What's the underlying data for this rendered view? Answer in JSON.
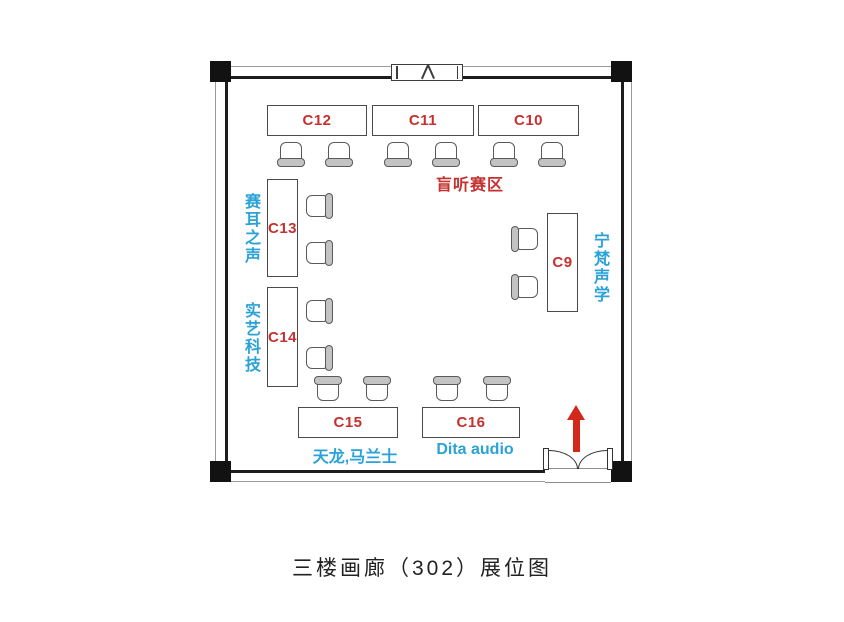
{
  "title": "三楼画廊（302）展位图",
  "colors": {
    "booth_label_red": "#c4312e",
    "brand_label_cyan": "#2aa2d8",
    "entrance_arrow_red": "#d2281c",
    "wall_black": "#1d1d1d"
  },
  "zones": {
    "blind_listening": "盲听赛区"
  },
  "booths": {
    "c9": {
      "label": "C9",
      "brand": "宁梵声学"
    },
    "c10": {
      "label": "C10"
    },
    "c11": {
      "label": "C11"
    },
    "c12": {
      "label": "C12"
    },
    "c13": {
      "label": "C13",
      "brand": "赛耳之声"
    },
    "c14": {
      "label": "C14",
      "brand": "实艺科技"
    },
    "c15": {
      "label": "C15",
      "brand": "天龙,马兰士"
    },
    "c16": {
      "label": "C16",
      "brand": "Dita audio"
    }
  },
  "icons": {
    "entrance_arrow": "up-arrow",
    "entrance_door": "double-swing-door",
    "window": "top-wall-window",
    "chair": "plan-view-chair",
    "column": "structural-column"
  }
}
